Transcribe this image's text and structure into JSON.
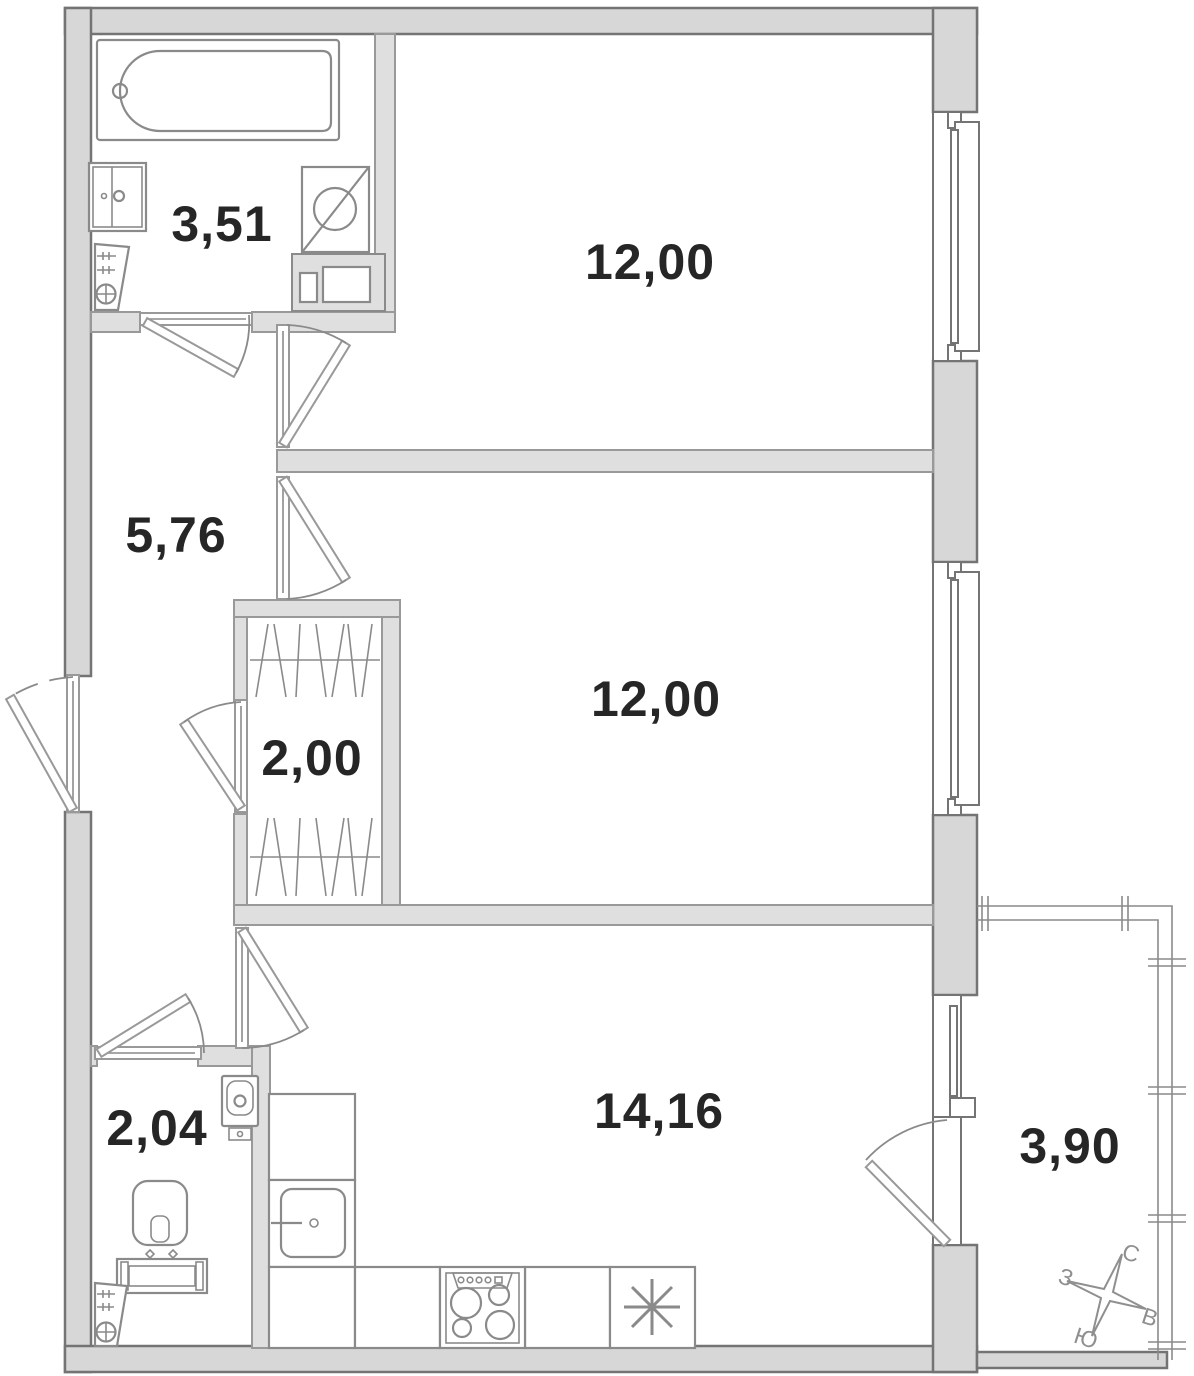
{
  "title": "2-room apartment floor plan",
  "rooms": [
    {
      "name": "bathroom",
      "area": "3,51"
    },
    {
      "name": "room-top",
      "area": "12,00"
    },
    {
      "name": "hallway",
      "area": "5,76"
    },
    {
      "name": "wardrobe",
      "area": "2,00"
    },
    {
      "name": "room-middle",
      "area": "12,00"
    },
    {
      "name": "wc",
      "area": "2,04"
    },
    {
      "name": "kitchen-living",
      "area": "14,16"
    },
    {
      "name": "balcony",
      "area": "3,90"
    }
  ],
  "compass": {
    "north": "С",
    "east": "В",
    "south": "Ю",
    "west": "З"
  },
  "colors": {
    "wall": "#d7d7d7",
    "partition": "#dfdfdf",
    "outline": "#747474",
    "outline2": "#999999",
    "fixture": "#8a8a8a",
    "label": "#262626",
    "compass": "#8f8f8f"
  }
}
